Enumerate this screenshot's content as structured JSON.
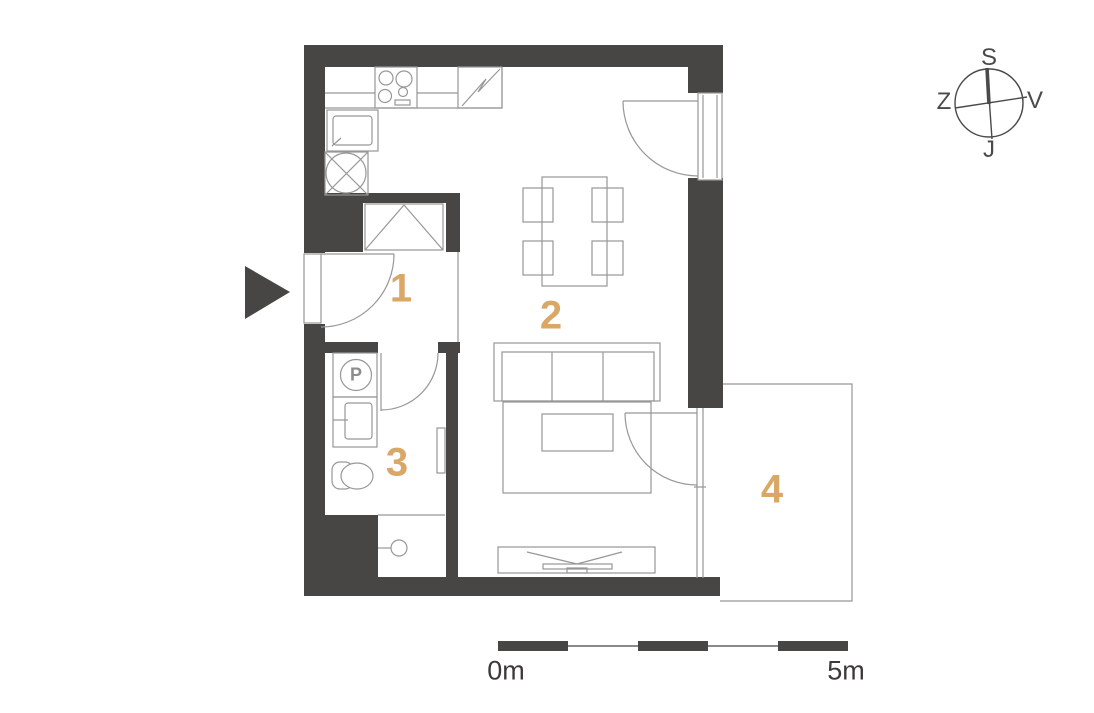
{
  "colors": {
    "wall": "#474644",
    "line": "#979797",
    "accent": "#d9a766",
    "compass": "#4a4a4a",
    "label": "#3b3a38",
    "bg": "#ffffff"
  },
  "rooms": [
    {
      "label": "1"
    },
    {
      "label": "2"
    },
    {
      "label": "3"
    },
    {
      "label": "4"
    }
  ],
  "compass": {
    "top": "S",
    "bottom": "J",
    "left": "Z",
    "right": "V"
  },
  "scale_bar": {
    "start": "0m",
    "end": "5m"
  },
  "fixtures": {
    "washing_machine_label": "P"
  }
}
